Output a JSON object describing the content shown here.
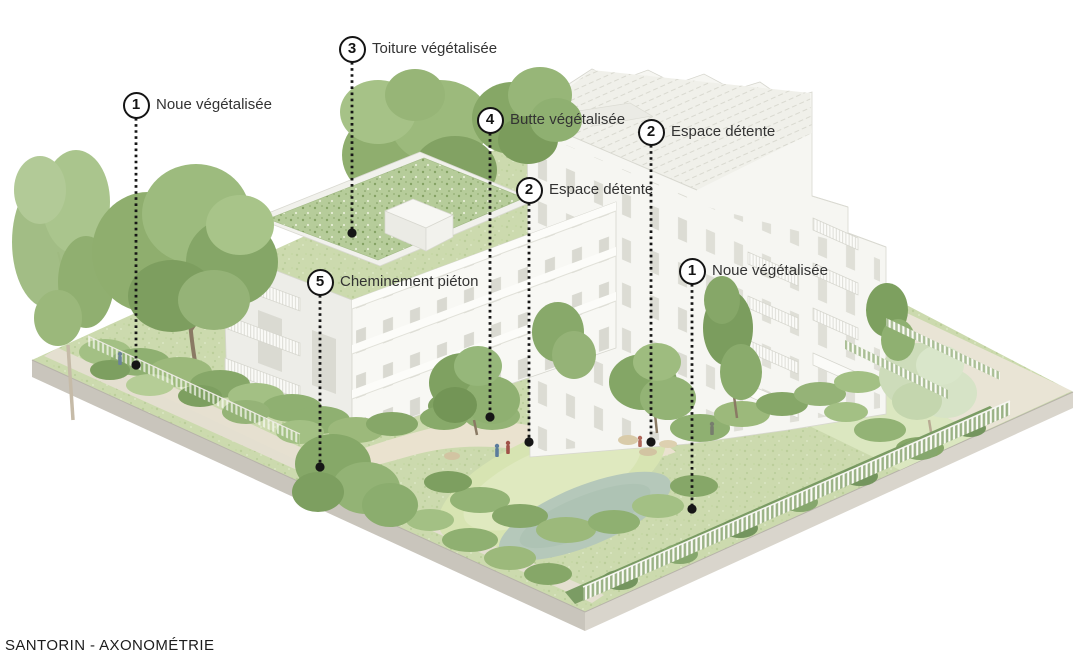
{
  "figure": {
    "caption": "SANTORIN - AXONOMÉTRIE"
  },
  "callouts": [
    {
      "number": "1",
      "label": "Noue végétalisée",
      "x": 136,
      "y": 105,
      "line_end_y": 365
    },
    {
      "number": "3",
      "label": "Toiture végétalisée",
      "x": 352,
      "y": 49,
      "line_end_y": 233
    },
    {
      "number": "4",
      "label": "Butte végétalisée",
      "x": 490,
      "y": 120,
      "line_end_y": 417
    },
    {
      "number": "2",
      "label": "Espace détente",
      "x": 529,
      "y": 190,
      "line_end_y": 442
    },
    {
      "number": "2",
      "label": "Espace détente",
      "x": 651,
      "y": 132,
      "line_end_y": 442
    },
    {
      "number": "1",
      "label": "Noue végétalisée",
      "x": 692,
      "y": 271,
      "line_end_y": 509
    },
    {
      "number": "5",
      "label": "Cheminement piéton",
      "x": 320,
      "y": 282,
      "line_end_y": 467
    }
  ],
  "style": {
    "leader_color": "#161616",
    "label_color": "#333333",
    "badge_fill": "#ffffff",
    "green_roof": "#b6cc9a",
    "building_white": "#f6f6f2"
  }
}
